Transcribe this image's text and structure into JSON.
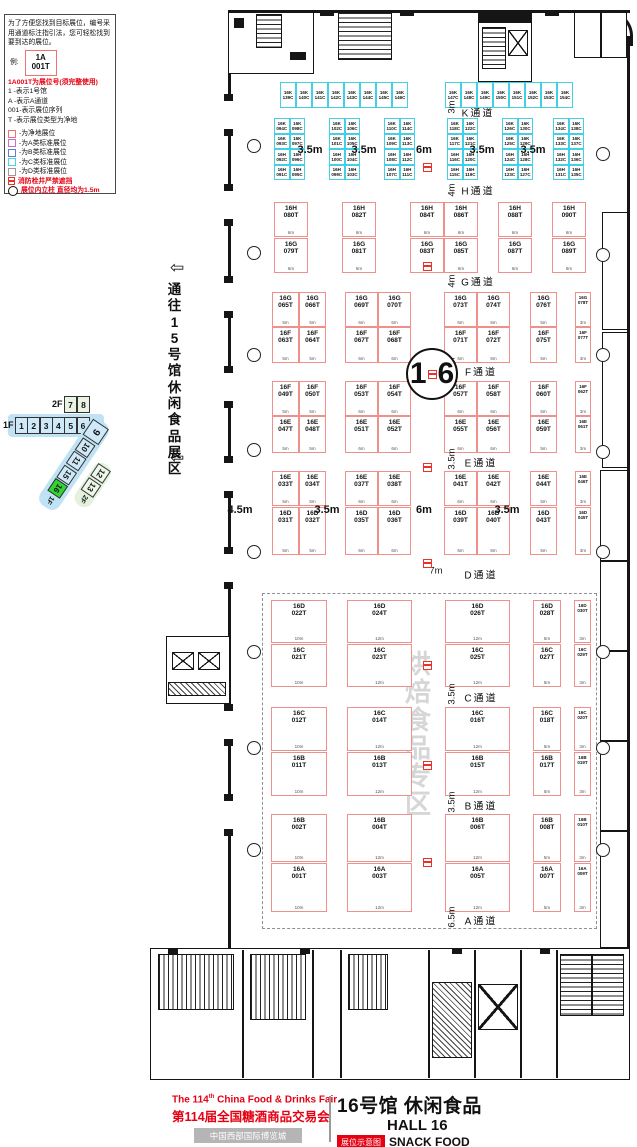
{
  "legend": {
    "intro_lines": [
      "为了方便您找到目标展位，编号采",
      "用通道标注指引法，您可轻松找到",
      "要到达的展位。"
    ],
    "example_label": "例:",
    "example_booth_line1": "1A",
    "example_booth_line2": "001T",
    "booth_no_note": "1A001T为展位号(须完整使用)",
    "code_lines": [
      "1    -表示1号馆",
      "A    -表示A通道",
      "001-表示展位序列",
      "T   -表示展位类型为净地"
    ],
    "color_items": [
      {
        "color": "#f0716d",
        "label": "-为净地展位"
      },
      {
        "color": "#cf6ad0",
        "label": "-为A类标准展位"
      },
      {
        "color": "#5b7fd4",
        "label": "-为B类标准展位"
      },
      {
        "color": "#4fd2e8",
        "label": "-为C类标准展位"
      },
      {
        "color": "#9a9a9a",
        "label": "-为D类标准展位"
      }
    ],
    "hydrant_note": "消防栓井严禁遮挡",
    "column_note": "展位内立柱 直径均为1.5m"
  },
  "navigator": {
    "floor2_label": "2F",
    "floor2_halls": [
      "7",
      "8"
    ],
    "floor1_label": "1F",
    "floor1_halls": [
      "1",
      "2",
      "3",
      "4",
      "5",
      "6"
    ],
    "corner_hall": "9",
    "wing_halls": [
      "10",
      "11",
      "15"
    ],
    "wing_current": "16",
    "wing_floor_label": "1F",
    "wing2_halls": [
      "12",
      "13"
    ],
    "wing2_floor_label": "2F"
  },
  "corridor": {
    "text": "通往15号馆休闲食品展区",
    "arrow_glyph": "⇦"
  },
  "hall_circle": {
    "digit1": "1",
    "digit2": "6"
  },
  "watermark": {
    "text": "烘焙食品专区"
  },
  "aisles": [
    {
      "name": "K通道",
      "dim": "3m",
      "x": 478,
      "y": 112,
      "dx": 452,
      "dy": 107
    },
    {
      "name": "H通道",
      "dim": "4m",
      "x": 478,
      "y": 190,
      "dx": 452,
      "dy": 190
    },
    {
      "name": "G通道",
      "dim": "4m",
      "x": 478,
      "y": 281,
      "dx": 452,
      "dy": 281
    },
    {
      "name": "F通道",
      "dim": "3.5m",
      "x": 481,
      "y": 371,
      "dx": 452,
      "dy": 368
    },
    {
      "name": "E通道",
      "dim": "3.5m",
      "x": 481,
      "y": 462,
      "dx": 452,
      "dy": 459
    },
    {
      "name": "D通道",
      "dim": "7m",
      "x": 481,
      "y": 574,
      "dx": 436,
      "dy": 571,
      "horiz": true
    },
    {
      "name": "C通道",
      "dim": "3.5m",
      "x": 481,
      "y": 697,
      "dx": 452,
      "dy": 694
    },
    {
      "name": "B通道",
      "dim": "3.5m",
      "x": 481,
      "y": 805,
      "dx": 452,
      "dy": 802
    },
    {
      "name": "A通道",
      "dim": "6.5m",
      "x": 481,
      "y": 920,
      "dx": 452,
      "dy": 917
    }
  ],
  "dim_labels": [
    {
      "t": "3.5m",
      "x": 310,
      "y": 150
    },
    {
      "t": "3.5m",
      "x": 364,
      "y": 150
    },
    {
      "t": "6m",
      "x": 424,
      "y": 150
    },
    {
      "t": "3.5m",
      "x": 482,
      "y": 150
    },
    {
      "t": "3.5m",
      "x": 533,
      "y": 150
    },
    {
      "t": "4.5m",
      "x": 240,
      "y": 510
    },
    {
      "t": "3.5m",
      "x": 327,
      "y": 510
    },
    {
      "t": "6m",
      "x": 424,
      "y": 510
    },
    {
      "t": "3.5m",
      "x": 507,
      "y": 510
    }
  ],
  "hydrants": [
    [
      423,
      163
    ],
    [
      423,
      262
    ],
    [
      423,
      463
    ],
    [
      423,
      559
    ],
    [
      423,
      661
    ],
    [
      423,
      761
    ],
    [
      423,
      858
    ]
  ],
  "pillars": [
    [
      247,
      139
    ],
    [
      247,
      246
    ],
    [
      247,
      348
    ],
    [
      247,
      443
    ],
    [
      247,
      545
    ],
    [
      247,
      645
    ],
    [
      247,
      741
    ],
    [
      247,
      843
    ],
    [
      596,
      147
    ],
    [
      596,
      248
    ],
    [
      596,
      348
    ],
    [
      596,
      445
    ],
    [
      596,
      545
    ],
    [
      596,
      645
    ],
    [
      596,
      741
    ],
    [
      596,
      843
    ]
  ],
  "booth_rows": [
    {
      "prefix": "16K",
      "cls": "c",
      "y": 82,
      "h": 26,
      "items": [
        [
          "139C",
          280,
          16
        ],
        [
          "140C",
          296,
          16
        ],
        [
          "141C",
          312,
          16
        ],
        [
          "142C",
          328,
          16
        ],
        [
          "143C",
          344,
          16
        ],
        [
          "144C",
          360,
          16
        ],
        [
          "145C",
          376,
          16
        ],
        [
          "146C",
          392,
          16
        ],
        [
          "147C",
          445,
          16
        ],
        [
          "148C",
          461,
          16
        ],
        [
          "149C",
          477,
          16
        ],
        [
          "150C",
          493,
          16
        ],
        [
          "151C",
          509,
          16
        ],
        [
          "152C",
          525,
          16
        ],
        [
          "153C",
          541,
          16
        ],
        [
          "154C",
          557,
          16
        ]
      ]
    },
    {
      "prefix": "16K",
      "cls": "c",
      "y": 118,
      "h": 15.5,
      "items": [
        [
          "094C",
          274,
          15.5
        ],
        [
          "098C",
          289.5,
          15.5
        ],
        [
          "102C",
          329,
          15.5
        ],
        [
          "106C",
          344.5,
          15.5
        ],
        [
          "110C",
          384,
          15.5
        ],
        [
          "114C",
          399.5,
          15.5
        ],
        [
          "118C",
          447,
          15.5
        ],
        [
          "122C",
          462.5,
          15.5
        ],
        [
          "126C",
          502,
          15.5
        ],
        [
          "130C",
          517.5,
          15.5
        ],
        [
          "134C",
          553,
          15.5
        ],
        [
          "138C",
          568.5,
          15.5
        ]
      ]
    },
    {
      "prefix": "16K",
      "cls": "c",
      "y": 133.5,
      "h": 15.5,
      "items": [
        [
          "093C",
          274,
          15.5
        ],
        [
          "097C",
          289.5,
          15.5
        ],
        [
          "101C",
          329,
          15.5
        ],
        [
          "105C",
          344.5,
          15.5
        ],
        [
          "109C",
          384,
          15.5
        ],
        [
          "113C",
          399.5,
          15.5
        ],
        [
          "117C",
          447,
          15.5
        ],
        [
          "121C",
          462.5,
          15.5
        ],
        [
          "125C",
          502,
          15.5
        ],
        [
          "129C",
          517.5,
          15.5
        ],
        [
          "133C",
          553,
          15.5
        ],
        [
          "137C",
          568.5,
          15.5
        ]
      ]
    },
    {
      "prefix": "16H",
      "cls": "c",
      "y": 149,
      "h": 15.5,
      "items": [
        [
          "092C",
          274,
          15.5
        ],
        [
          "096C",
          289.5,
          15.5
        ],
        [
          "100C",
          329,
          15.5
        ],
        [
          "104C",
          344.5,
          15.5
        ],
        [
          "108C",
          384,
          15.5
        ],
        [
          "112C",
          399.5,
          15.5
        ],
        [
          "116C",
          447,
          15.5
        ],
        [
          "120C",
          462.5,
          15.5
        ],
        [
          "124C",
          502,
          15.5
        ],
        [
          "128C",
          517.5,
          15.5
        ],
        [
          "132C",
          553,
          15.5
        ],
        [
          "136C",
          568.5,
          15.5
        ]
      ]
    },
    {
      "prefix": "16H",
      "cls": "c",
      "y": 164.5,
      "h": 15.5,
      "items": [
        [
          "091C",
          274,
          15.5
        ],
        [
          "095C",
          289.5,
          15.5
        ],
        [
          "099C",
          329,
          15.5
        ],
        [
          "103C",
          344.5,
          15.5
        ],
        [
          "107C",
          384,
          15.5
        ],
        [
          "111C",
          399.5,
          15.5
        ],
        [
          "115C",
          447,
          15.5
        ],
        [
          "119C",
          462.5,
          15.5
        ],
        [
          "123C",
          502,
          15.5
        ],
        [
          "127C",
          517.5,
          15.5
        ],
        [
          "131C",
          553,
          15.5
        ],
        [
          "135C",
          568.5,
          15.5
        ]
      ]
    },
    {
      "prefix": "16H",
      "cls": "t",
      "y": 202,
      "h": 35,
      "items": [
        [
          "080T",
          274,
          34,
          "6m"
        ],
        [
          "082T",
          342,
          34,
          "6m"
        ],
        [
          "084T",
          410,
          34,
          "6m"
        ],
        [
          "086T",
          444,
          34,
          "6m"
        ],
        [
          "088T",
          498,
          34,
          "6m"
        ],
        [
          "090T",
          552,
          34,
          "6m"
        ]
      ]
    },
    {
      "prefix": "16G",
      "cls": "t",
      "y": 238,
      "h": 35,
      "items": [
        [
          "079T",
          274,
          34,
          "6m"
        ],
        [
          "081T",
          342,
          34,
          "6m"
        ],
        [
          "083T",
          410,
          34,
          "6m"
        ],
        [
          "085T",
          444,
          34,
          "6m"
        ],
        [
          "087T",
          498,
          34,
          "6m"
        ],
        [
          "089T",
          552,
          34,
          "6m"
        ]
      ]
    },
    {
      "prefix": "16G",
      "cls": "t",
      "y": 292,
      "h": 35,
      "items": [
        [
          "065T",
          272,
          27,
          "5m"
        ],
        [
          "066T",
          299,
          27,
          "5m"
        ],
        [
          "069T",
          345,
          33,
          "6m"
        ],
        [
          "070T",
          378,
          33,
          "6m"
        ],
        [
          "073T",
          444,
          33,
          "6m"
        ],
        [
          "074T",
          477,
          33,
          "6m"
        ],
        [
          "076T",
          530,
          27,
          "5m"
        ],
        [
          "078T",
          575,
          16,
          "3m"
        ]
      ]
    },
    {
      "prefix": "16F",
      "cls": "t",
      "y": 327,
      "h": 36,
      "items": [
        [
          "063T",
          272,
          27,
          "5m"
        ],
        [
          "064T",
          299,
          27,
          "5m"
        ],
        [
          "067T",
          345,
          33,
          "6m"
        ],
        [
          "068T",
          378,
          33,
          "6m"
        ],
        [
          "071T",
          444,
          33,
          "6m"
        ],
        [
          "072T",
          477,
          33,
          "6m"
        ],
        [
          "075T",
          530,
          27,
          "5m"
        ],
        [
          "077T",
          575,
          16,
          "3m"
        ]
      ]
    },
    {
      "prefix": "16F",
      "cls": "t",
      "y": 381,
      "h": 35,
      "items": [
        [
          "049T",
          272,
          27,
          "5m"
        ],
        [
          "050T",
          299,
          27,
          "5m"
        ],
        [
          "053T",
          345,
          33,
          "6m"
        ],
        [
          "054T",
          378,
          33,
          "6m"
        ],
        [
          "057T",
          444,
          33,
          "6m"
        ],
        [
          "058T",
          477,
          33,
          "6m"
        ],
        [
          "060T",
          530,
          27,
          "5m"
        ],
        [
          "062T",
          575,
          16,
          "3m"
        ]
      ]
    },
    {
      "prefix": "16E",
      "cls": "t",
      "y": 416,
      "h": 37,
      "items": [
        [
          "047T",
          272,
          27,
          "5m"
        ],
        [
          "048T",
          299,
          27,
          "5m"
        ],
        [
          "051T",
          345,
          33,
          "6m"
        ],
        [
          "052T",
          378,
          33,
          "6m"
        ],
        [
          "055T",
          444,
          33,
          "6m"
        ],
        [
          "056T",
          477,
          33,
          "6m"
        ],
        [
          "059T",
          530,
          27,
          "5m"
        ],
        [
          "061T",
          575,
          16,
          "3m"
        ]
      ]
    },
    {
      "prefix": "16E",
      "cls": "t",
      "y": 471,
      "h": 35,
      "items": [
        [
          "033T",
          272,
          27,
          "5m"
        ],
        [
          "034T",
          299,
          27,
          "5m"
        ],
        [
          "037T",
          345,
          33,
          "6m"
        ],
        [
          "038T",
          378,
          33,
          "6m"
        ],
        [
          "041T",
          444,
          33,
          "6m"
        ],
        [
          "042T",
          477,
          33,
          "6m"
        ],
        [
          "044T",
          530,
          27,
          "5m"
        ],
        [
          "046T",
          575,
          16,
          "3m"
        ]
      ]
    },
    {
      "prefix": "16D",
      "cls": "t",
      "y": 507,
      "h": 48,
      "items": [
        [
          "031T",
          272,
          27,
          "5m"
        ],
        [
          "032T",
          299,
          27,
          "5m"
        ],
        [
          "035T",
          345,
          33,
          "6m"
        ],
        [
          "036T",
          378,
          33,
          "6m"
        ],
        [
          "039T",
          444,
          33,
          "6m"
        ],
        [
          "040T",
          477,
          33,
          "6m"
        ],
        [
          "043T",
          530,
          27,
          "5m"
        ],
        [
          "045T",
          575,
          16,
          "3m"
        ]
      ]
    },
    {
      "prefix": "16D",
      "cls": "t",
      "y": 600,
      "h": 43,
      "items": [
        [
          "022T",
          271,
          56,
          "10m"
        ],
        [
          "024T",
          347,
          65,
          "12m"
        ],
        [
          "026T",
          445,
          65,
          "12m"
        ],
        [
          "028T",
          533,
          28,
          "5m"
        ],
        [
          "030T",
          574,
          17,
          "3m"
        ]
      ]
    },
    {
      "prefix": "16C",
      "cls": "t",
      "y": 644,
      "h": 43,
      "items": [
        [
          "021T",
          271,
          56,
          "10m"
        ],
        [
          "023T",
          347,
          65,
          "12m"
        ],
        [
          "025T",
          445,
          65,
          "12m"
        ],
        [
          "027T",
          533,
          28,
          "5m"
        ],
        [
          "029T",
          574,
          17,
          "3m"
        ]
      ]
    },
    {
      "prefix": "16C",
      "cls": "t",
      "y": 707,
      "h": 44,
      "items": [
        [
          "012T",
          271,
          56,
          "10m"
        ],
        [
          "014T",
          347,
          65,
          "12m"
        ],
        [
          "016T",
          445,
          65,
          "12m"
        ],
        [
          "018T",
          533,
          28,
          "5m"
        ],
        [
          "020T",
          574,
          17,
          "3m"
        ]
      ]
    },
    {
      "prefix": "16B",
      "cls": "t",
      "y": 752,
      "h": 44,
      "items": [
        [
          "011T",
          271,
          56,
          "10m"
        ],
        [
          "013T",
          347,
          65,
          "12m"
        ],
        [
          "015T",
          445,
          65,
          "12m"
        ],
        [
          "017T",
          533,
          28,
          "5m"
        ],
        [
          "019T",
          574,
          17,
          "3m"
        ]
      ]
    },
    {
      "prefix": "16B",
      "cls": "t",
      "y": 814,
      "h": 48,
      "items": [
        [
          "002T",
          271,
          56,
          "10m"
        ],
        [
          "004T",
          347,
          65,
          "12m"
        ],
        [
          "006T",
          445,
          65,
          "12m"
        ],
        [
          "008T",
          533,
          28,
          "5m"
        ],
        [
          "010T",
          574,
          17,
          "3m"
        ]
      ]
    },
    {
      "prefix": "16A",
      "cls": "t",
      "y": 863,
      "h": 49,
      "items": [
        [
          "001T",
          271,
          56,
          "10m"
        ],
        [
          "003T",
          347,
          65,
          "12m"
        ],
        [
          "005T",
          445,
          65,
          "12m"
        ],
        [
          "007T",
          533,
          28,
          "5m"
        ],
        [
          "009T",
          574,
          17,
          "3m"
        ]
      ]
    }
  ],
  "title_block": {
    "fair_en_prefix": "The 114",
    "fair_en_sup": "th",
    "fair_en_suffix": " China Food & Drinks Fair",
    "fair_cn": "第114届全国糖酒商品交易会",
    "venue": "中国西部国际博览城",
    "hall_cn": "16号馆 休闲食品",
    "hall_en": "HALL 16",
    "map_label": "展位示意图",
    "category_en": "SNACK FOOD"
  },
  "colors": {
    "accent_red": "#e60012",
    "booth_net": "#f0908c",
    "booth_c_class": "#43cfe4",
    "nav_current_green": "#35d435",
    "watermark_gray": "#d6d6d6"
  }
}
